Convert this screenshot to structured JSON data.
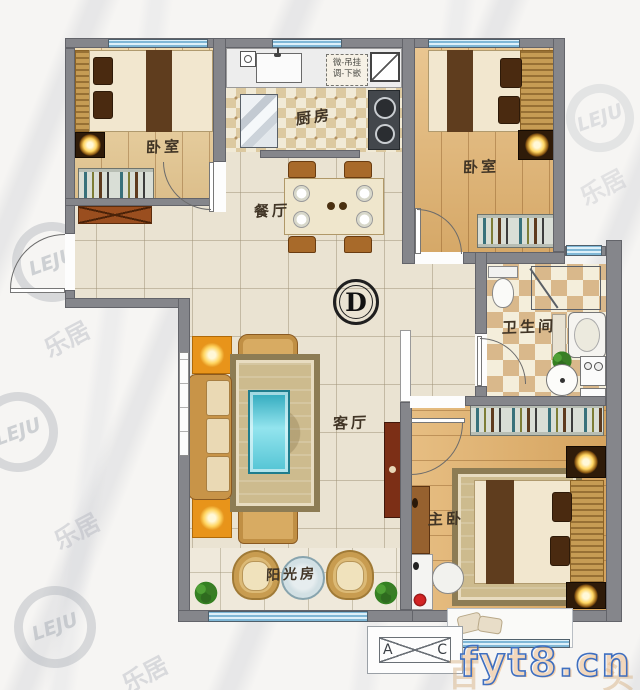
{
  "unit": {
    "type_mark": "D"
  },
  "rooms": {
    "bedroom_tl": {
      "label": "卧室"
    },
    "kitchen": {
      "label": "厨房"
    },
    "bedroom_tr": {
      "label": "卧室"
    },
    "dining": {
      "label": "餐厅"
    },
    "living": {
      "label": "客厅"
    },
    "bathroom": {
      "label": "卫生间"
    },
    "master": {
      "label": "主卧"
    },
    "sunroom": {
      "label": "阳光房"
    }
  },
  "annotations": {
    "kitchen_note": {
      "line1": "微-吊挂",
      "line2": "调-下嵌"
    },
    "ac_platform": {
      "left": "A",
      "right": "C"
    }
  },
  "watermarks": {
    "brand": "LEJU",
    "brand_cn": "乐居",
    "site": "fyt8.cn",
    "site_bg_left": "百",
    "site_bg_right": "头"
  },
  "colors": {
    "wall": "#85868b",
    "window_blue": "#b3d8ea",
    "wood_floor": "#e5ba79",
    "tile_floor": "#eae3d2",
    "lamp_accent": "#e8941a",
    "glass_table_teal": "#49c2d4",
    "site_watermark_blue": "#3f6fc0"
  }
}
